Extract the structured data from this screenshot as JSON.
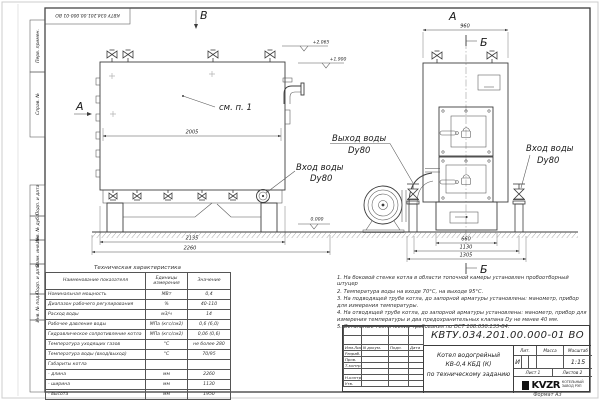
{
  "frame": {
    "doc_number_top": "КВТУ 034.201.00.000-01  ВО",
    "stamps": [
      "Перв. примен.",
      "Справ. №",
      "Подп. и дата",
      "Инв. № дубл.",
      "Взам. инв. №",
      "Подп. и дата",
      "Инв. № подл."
    ],
    "format_label": "Формат  А3"
  },
  "drawing": {
    "view_b": "В",
    "view_a_side": "А",
    "view_a_front": "А",
    "section_b_top": "Б",
    "section_b_bottom": "Б",
    "see_note": "см. п. 1",
    "dims": {
      "body_length": "2005",
      "base_length": "2135",
      "total_length": "2260",
      "front_width": "960",
      "pedestal_width": "660",
      "valve_span": "1130",
      "total_width": "1305"
    },
    "elevations": {
      "pipe_top": "+2.065",
      "pipe_mid": "+1.900",
      "ground": "0.000"
    },
    "ports": {
      "outlet": "Выход воды",
      "outlet_dn": "Dy80",
      "inlet_front": "Вход воды",
      "inlet_front_dn": "Dy80",
      "inlet_side": "Вход воды",
      "inlet_side_dn": "Dy80"
    }
  },
  "spec_table": {
    "title": "Техническая характеристика",
    "headers": [
      "Наименование показателя",
      "Единицы измерения",
      "Значение"
    ],
    "rows": [
      {
        "name": "Номинальная мощность",
        "unit": "МВт",
        "value": "0,4"
      },
      {
        "name": "Диапазон рабочего регулирования",
        "unit": "%",
        "value": "40-110"
      },
      {
        "name": "Расход воды",
        "unit": "м3/ч",
        "value": "14"
      },
      {
        "name": "Рабочее давление воды",
        "unit": "МПа (кгс/см2)",
        "value": "0,6 (6,0)"
      },
      {
        "name": "Гидравлическое сопротивление котла",
        "unit": "МПа (кгс/см2)",
        "value": "0,06 (0,6)"
      },
      {
        "name": "Температура уходящих газов",
        "unit": "°С",
        "value": "не более 280"
      },
      {
        "name": "Температура воды (вход/выход)",
        "unit": "°С",
        "value": "70/95"
      },
      {
        "name": "Габариты котла",
        "unit": "",
        "value": ""
      },
      {
        "name": "  - длина",
        "unit": "мм",
        "value": "2260"
      },
      {
        "name": "  - ширина",
        "unit": "мм",
        "value": "1130"
      },
      {
        "name": "  - высота",
        "unit": "мм",
        "value": "1950"
      }
    ]
  },
  "notes": [
    "1.  На боковой стенке котла в области топочной камеры установлен пробоотборный штуцер",
    "2.  Температура воды на входе 70°С, на выходе 95°С.",
    "3.  На подводящей трубе котла, до запорной арматуры установлены: манометр, прибор для измерения температуры.",
    "4.  На отводящей трубе котла, до запорной арматуры установлены: манометр, прибор для измерения температуры и два предохранительных клапана Dу не менее 40 мм.",
    "5.  Остальные технические требования по ОСТ 108.030.133-84."
  ],
  "title_block": {
    "doc_number": "КВТУ.034.201.00.000-01  ВО",
    "title_line1": "Котел водогрейный",
    "title_line2": "КВ-0,4 КБД (К)",
    "title_line3": "по техническому заданию",
    "header_cells": [
      "Изм.Лист",
      "N докум.",
      "Подп.",
      "Дата"
    ],
    "row_labels": [
      "Разраб.",
      "Пров.",
      "Т.контр.",
      "",
      "Н.контр.",
      "Утв."
    ],
    "lit_label": "Лит.",
    "mass_label": "Масса",
    "scale_label": "Масштаб",
    "lit_value": "И",
    "scale_value": "1:15",
    "sheet_label": "Лист",
    "sheet_value": "1",
    "sheets_label": "Листов",
    "sheets_value": "2",
    "company_logo": "KVZR",
    "company_line1": "КОТЕЛЬНЫЙ",
    "company_line2": "ЗАВОД РЭП"
  }
}
